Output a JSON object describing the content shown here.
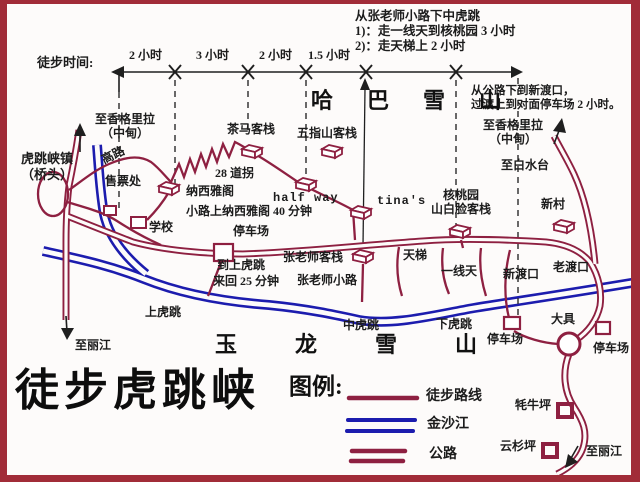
{
  "map_title": "徒步虎跳峡",
  "colors": {
    "road": "#8e2041",
    "river": "#1c1cae",
    "border": "#a12c38",
    "ink": "#1a1a1a"
  },
  "timeline": {
    "label": "徒步时间:",
    "segments": [
      "2 小时",
      "3 小时",
      "2 小时",
      "1.5 小时"
    ]
  },
  "notes": {
    "zhang_route": [
      "从张老师小路下中虎跳",
      "1)：走一线天到核桃园 3 小时",
      "2)：走天梯上 2 小时"
    ],
    "ferry": [
      "从公路下到新渡口，",
      "过渡上到对面停车场 2 小时。"
    ]
  },
  "mountains": {
    "haba": "哈巴雪山",
    "yulong": "玉龙雪山"
  },
  "places": {
    "to_shangrila": "至香格里拉",
    "zhongdian": "（中甸）",
    "qiaotou_1": "虎跳峡镇",
    "qiaotou_2": "（桥头）",
    "ticket_office": "售票处",
    "high_road": "高路",
    "school": "学校",
    "chama_inn": "茶马客栈",
    "wuzhishan_inn": "五指山客栈",
    "bends_28": "28 道拐",
    "naxi_inn": "纳西雅阁",
    "halfway": "half way",
    "tinas": "tina's",
    "hetaoyuan": "核桃园",
    "shanbailian_inn": "山白脸客栈",
    "xincun": "新村",
    "to_baishuitai": "至白水台",
    "naxi_path_note": "小路上纳西雅阁 40 分钟",
    "parking": "停车场",
    "to_upper_1": "到上虎跳",
    "to_upper_2": "来回 25 分钟",
    "zhang_inn": "张老师客栈",
    "zhang_path": "张老师小路",
    "tianti": "天梯",
    "yixiantian": "一线天",
    "new_ferry": "新渡口",
    "old_ferry": "老渡口",
    "upper_tiger": "上虎跳",
    "middle_tiger": "中虎跳",
    "lower_tiger": "下虎跳",
    "daju": "大具",
    "maoniuping": "牦牛坪",
    "yunshanping": "云杉坪",
    "to_lijiang": "至丽江"
  },
  "legend": {
    "heading": "图例:",
    "trail": "徒步路线",
    "river": "金沙江",
    "road": "公路"
  }
}
